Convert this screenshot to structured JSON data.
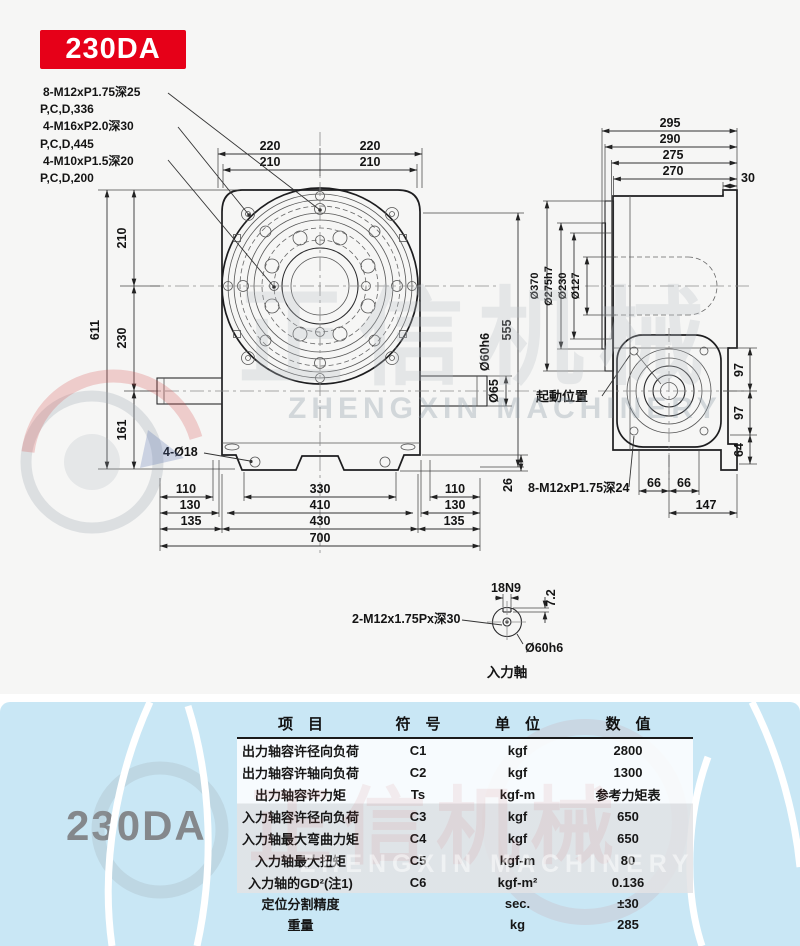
{
  "badge": "230DA",
  "notes": [
    "8-M12xP1.75深25",
    "P,C,D,336",
    "4-M16xP2.0深30",
    "P,C,D,445",
    "4-M10xP1.5深20",
    "P,C,D,200"
  ],
  "front": {
    "top_dims": [
      "220",
      "220",
      "210",
      "210"
    ],
    "left_dims": [
      "611",
      "210",
      "230",
      "161"
    ],
    "holes_label": "4-Ø18",
    "bottom_dims": [
      "110",
      "330",
      "110",
      "130",
      "410",
      "130",
      "135",
      "430",
      "135",
      "700"
    ],
    "right_dims": [
      "555",
      "Ø60h6",
      "Ø65",
      "26"
    ]
  },
  "side": {
    "top_dims": [
      "295",
      "290",
      "275",
      "270",
      "30"
    ],
    "dia_labels": [
      "Ø370",
      "Ø275h7",
      "Ø230",
      "Ø127"
    ],
    "start_label": "起動位置",
    "bolt_note": "8-M12xP1.75深24",
    "bottom_dims": [
      "66",
      "66",
      "147"
    ],
    "right_dims": [
      "97",
      "97",
      "64"
    ]
  },
  "detail": {
    "keyway_width": "18N9",
    "keyway_depth": "7.2",
    "tap_note": "2-M12x1.75Px深30",
    "shaft_dia": "Ø60h6",
    "title": "入力軸"
  },
  "watermark": {
    "latin": "ZHENGXIN MACHINERY",
    "cn": "正信机械"
  },
  "panel": {
    "model": "230DA",
    "table": {
      "headers": [
        "项　目",
        "符　号",
        "单　位",
        "数　值"
      ],
      "rows": [
        {
          "item": "出力轴容许径向负荷",
          "symbol": "C1",
          "unit": "kgf",
          "value": "2800"
        },
        {
          "item": "出力轴容许轴向负荷",
          "symbol": "C2",
          "unit": "kgf",
          "value": "1300"
        },
        {
          "item": "出力轴容许力矩",
          "symbol": "Ts",
          "unit": "kgf-m",
          "value": "参考力矩表"
        },
        {
          "item": "入力轴容许径向负荷",
          "symbol": "C3",
          "unit": "kgf",
          "value": "650"
        },
        {
          "item": "入力轴最大弯曲力矩",
          "symbol": "C4",
          "unit": "kgf",
          "value": "650"
        },
        {
          "item": "入力轴最大扭矩",
          "symbol": "C5",
          "unit": "kgf-m",
          "value": "80"
        },
        {
          "item": "入力轴的GD²(注1)",
          "symbol": "C6",
          "unit": "kgf-m²",
          "value": "0.136"
        },
        {
          "item": "定位分割精度",
          "symbol": "",
          "unit": "sec.",
          "value": "±30"
        },
        {
          "item": "重量",
          "symbol": "",
          "unit": "kg",
          "value": "285"
        }
      ]
    }
  }
}
